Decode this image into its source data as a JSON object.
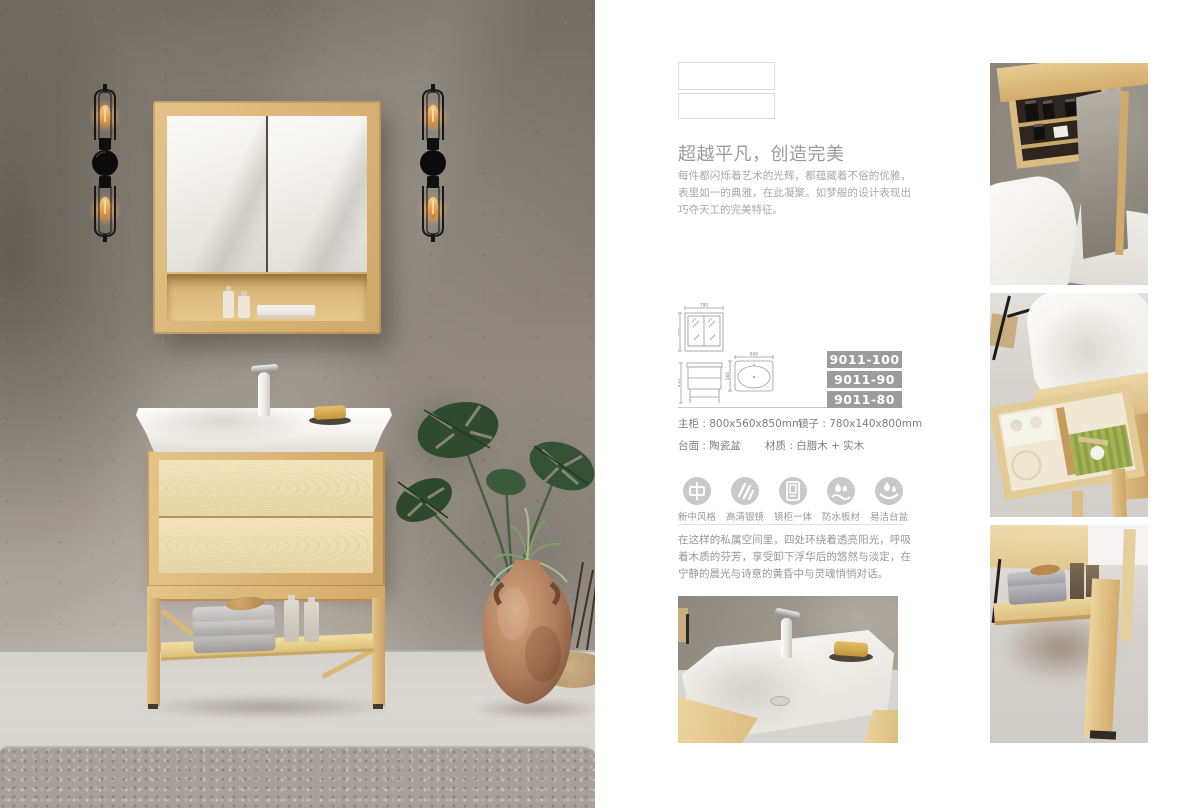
{
  "headline": {
    "title": "超越平凡，创造完美",
    "body": "每件都闪烁着艺术的光辉，都蕴藏着不俗的优雅，表里如一的典雅，在此凝聚。如梦般的设计表现出巧夺天工的完美特征。"
  },
  "models": [
    "9011-100",
    "9011-90",
    "9011-80"
  ],
  "diagrams": {
    "mirror": {
      "width": "780",
      "height": "800"
    },
    "vanity": {
      "height": "850"
    },
    "basin": {
      "width": "800",
      "depth": "560"
    }
  },
  "specs": {
    "main_cabinet": "主柜 : 800x560x850mm",
    "mirror": "镜子 : 780x140x800mm",
    "countertop": "台面 : 陶瓷盆",
    "material": "材质 : 白腊木 + 实木"
  },
  "features": [
    {
      "icon": "zhong-character-icon",
      "label": "新中风格"
    },
    {
      "icon": "mirror-shine-icon",
      "label": "高清银镜"
    },
    {
      "icon": "mirror-cabinet-icon",
      "label": "镜柜一体"
    },
    {
      "icon": "waterproof-drops-icon",
      "label": "防水板材"
    },
    {
      "icon": "easy-clean-basin-icon",
      "label": "易洁台盆"
    }
  ],
  "closing": {
    "body": "在这样的私属空间里，四处环绕着透亮阳光，呼吸着木质的芬芳，享受卸下浮华后的悠然与淡定，在宁静的晨光与诗意的黄昏中与灵魂悄悄对话。"
  },
  "colors": {
    "badge_bg": "#9c9c9c",
    "badge_text": "#ffffff",
    "title_gray": "#9b9b9b",
    "wood": "#ddbb82",
    "wall_gray": "#847c72"
  }
}
